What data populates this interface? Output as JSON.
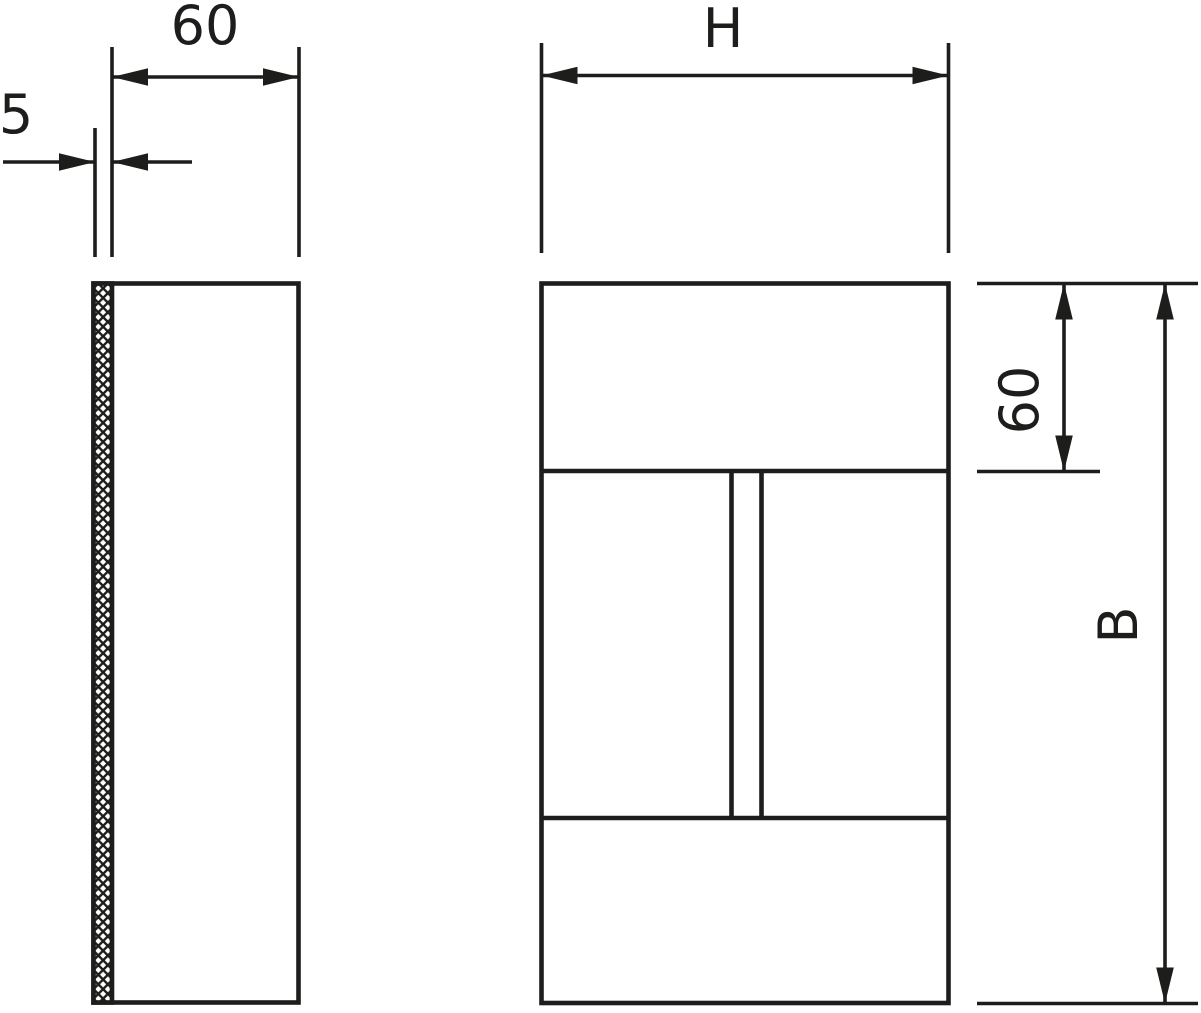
{
  "drawing": {
    "kind": "technical-drawing",
    "background_color": "#ffffff",
    "line_color": "#1d1d1b",
    "hatch_style": "crosshatch-seal-strip",
    "side_view": {
      "width_dim": {
        "label": "60",
        "orientation": "horizontal"
      },
      "thickness_dim": {
        "label": "5",
        "orientation": "horizontal"
      }
    },
    "front_view": {
      "width_dim": {
        "label": "H",
        "orientation": "horizontal"
      },
      "top_section_dim": {
        "label": "60",
        "orientation": "vertical"
      },
      "height_dim": {
        "label": "B",
        "orientation": "vertical"
      }
    }
  }
}
